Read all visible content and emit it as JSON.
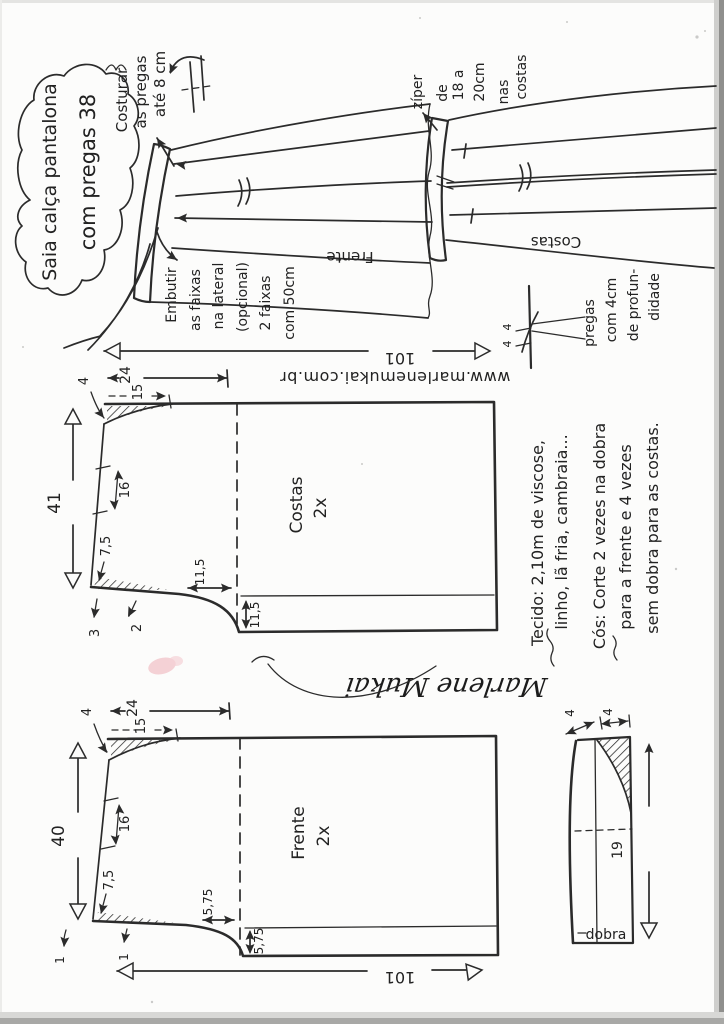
{
  "doc": {
    "title_lines": [
      "Saia calça pantalona",
      "com pregas 38"
    ],
    "watermark": "www.marlenemukai.com.br",
    "signature": "Marlene Mukai"
  },
  "sketches": {
    "front": {
      "label": "Frente",
      "sew_note": [
        "Costurar",
        "as pregas",
        "até 8 cm"
      ],
      "insert_note": [
        "Embutir",
        "as faixas",
        "na lateral",
        "(opcional)",
        "2 faixas",
        "com 50cm"
      ]
    },
    "back": {
      "label": "Costas",
      "zipper_note": [
        "zíper",
        "de",
        "18 a",
        "20cm",
        "nas",
        "costas"
      ],
      "pleat_note": [
        "pregas",
        "com 4cm",
        "de profun-",
        "didade"
      ],
      "pleat_depths": [
        "4",
        "4"
      ]
    }
  },
  "notes": {
    "fabric_lines": [
      "Tecido: 2,10m de viscose,",
      "linho, lã fria, cambraia...",
      "Cós: Corte 2 vezes na dobra",
      "para a frente e 4 vezes",
      "sem dobra para as costas."
    ]
  },
  "pieces": {
    "back": {
      "name": "Costas",
      "qty": "2x",
      "width": "101",
      "height": "41",
      "d4": "4",
      "d24": "24",
      "d15": "15",
      "d16": "16",
      "d75": "7,5",
      "d115h": "11,5",
      "d115v": "11,5",
      "da": "3",
      "db": "2"
    },
    "front": {
      "name": "Frente",
      "qty": "2x",
      "width": "101",
      "height": "40",
      "d4": "4",
      "d24": "24",
      "d15": "15",
      "d16": "16",
      "d75": "7,5",
      "d575h": "5,75",
      "d575v": "5,75",
      "da": "1",
      "db": "1"
    },
    "band": {
      "fold": "dobra",
      "length": "19",
      "wa": "4",
      "wb": "4"
    }
  }
}
